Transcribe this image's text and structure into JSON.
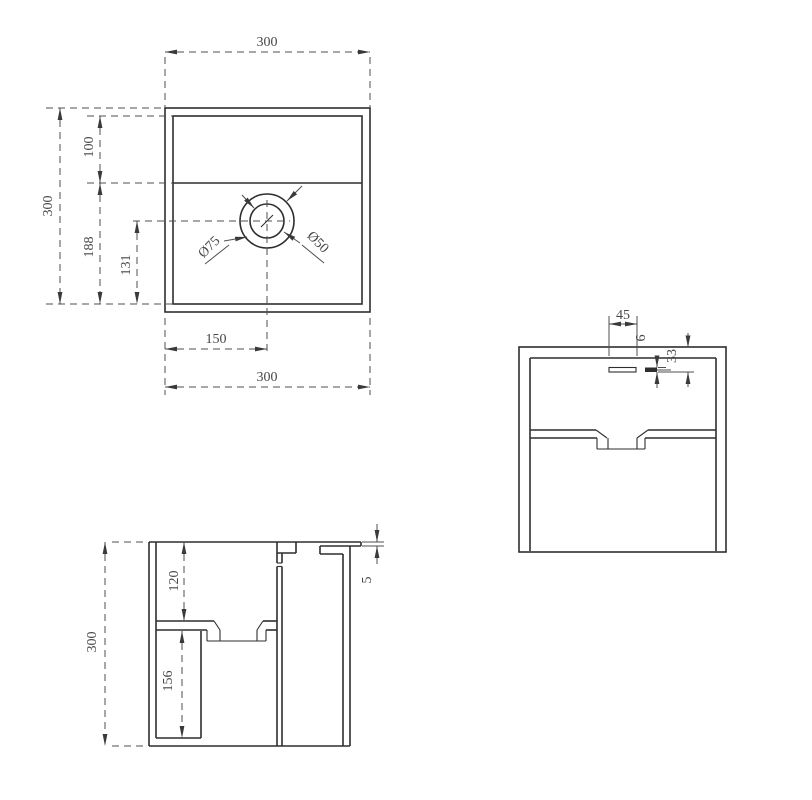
{
  "drawing": {
    "background": "#ffffff",
    "line_color": "#2e2e2e",
    "dim_color": "#4f4f4f",
    "views": {
      "plan": {
        "labels": {
          "top_width": "300",
          "left_height": "300",
          "deck_depth": "100",
          "basin_height": "188",
          "drain_from_bottom": "131",
          "drain_from_left": "150",
          "bottom_width": "300",
          "drain_outer_dia": "Ø75",
          "drain_inner_dia": "Ø50"
        }
      },
      "side": {
        "labels": {
          "slot_width": "45",
          "slot_height": "6",
          "slot_from_top": "33"
        }
      },
      "section": {
        "labels": {
          "overall_height": "300",
          "basin_depth": "120",
          "cavity_height": "156",
          "rim_thickness": "5"
        }
      }
    }
  }
}
